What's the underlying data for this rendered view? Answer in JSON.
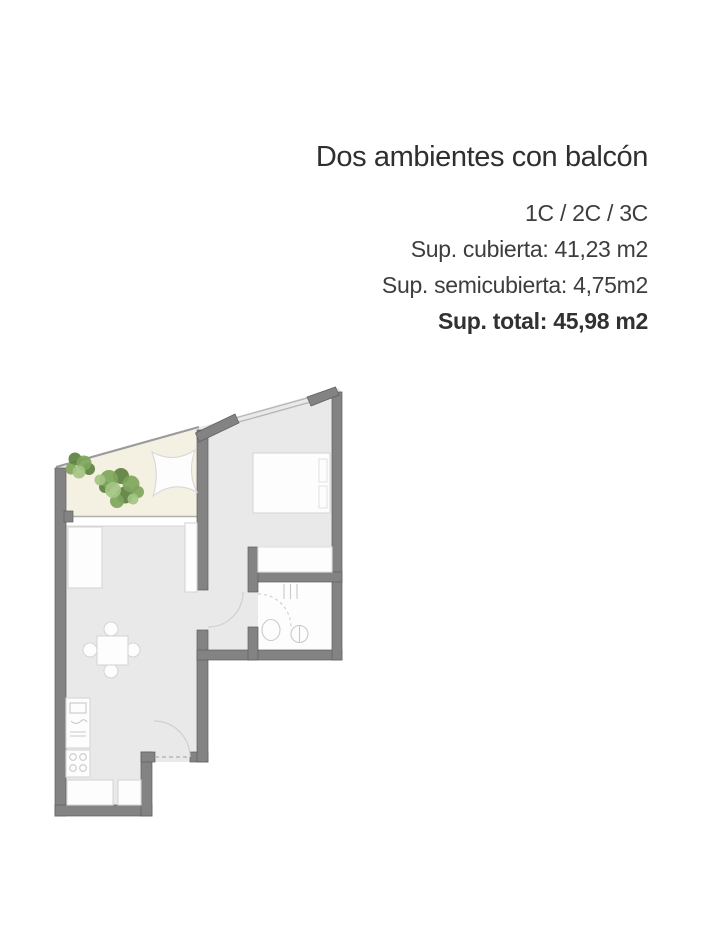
{
  "page": {
    "background": "#ffffff"
  },
  "listing": {
    "title": "Dos ambientes con balcón",
    "unit_types": "1C / 2C / 3C",
    "specs": [
      "Sup. cubierta: 41,23 m2",
      "Sup. semicubierta: 4,75m2",
      "Sup. total: 45,98 m2"
    ]
  },
  "floorplan": {
    "colors": {
      "wall": "#838383",
      "wall_outline": "#5e5e5e",
      "floor": "#e9e9e9",
      "balcony_floor": "#f4f1e2",
      "bathroom_floor": "#fdfdfd",
      "furniture": "#fdfdfd",
      "furniture_outline": "#d6d6d6",
      "plant_dark": "#5d8140",
      "plant_mid": "#7ea55b",
      "plant_light": "#a3c483"
    }
  }
}
